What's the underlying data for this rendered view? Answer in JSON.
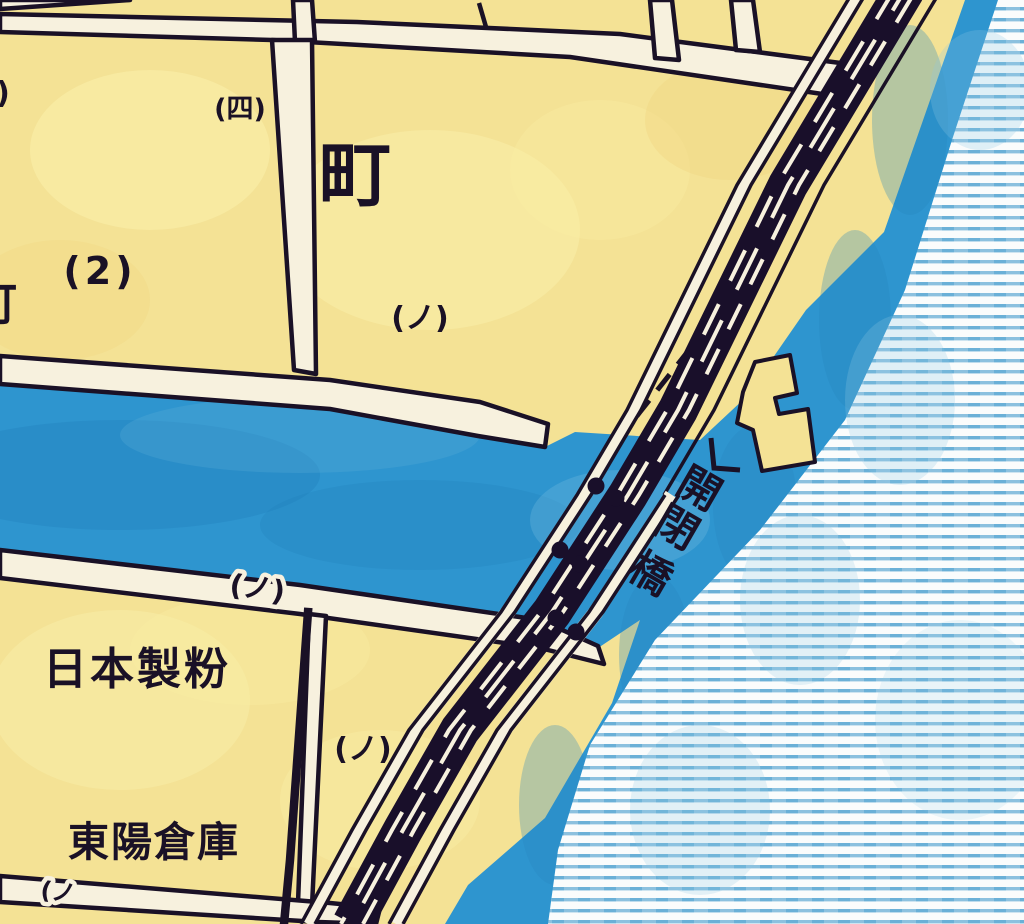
{
  "map": {
    "title": "vintage-japanese-city-map-detail",
    "labels": {
      "district_four": "(四)",
      "machi": "町",
      "block_2": "(2)",
      "no_upper": "(ノ)",
      "no_bank": "(ノ)",
      "no_mid": "(ノ)",
      "no_bottom": "(ノ",
      "nippon_seifun": "日本製粉",
      "toyo_soko": "東陽倉庫",
      "partial_left_paren": ")",
      "partial_cho": "町"
    },
    "bridge": {
      "name": "開閉橋",
      "chars": [
        "開",
        "閉",
        "橋"
      ]
    },
    "colors": {
      "land": "#f4e295",
      "water": "#2e95cf",
      "water_shadow": "#2383bd",
      "sea_stripe": "#79b6da",
      "street": "#f7f1de",
      "ink": "#1a1126"
    }
  }
}
